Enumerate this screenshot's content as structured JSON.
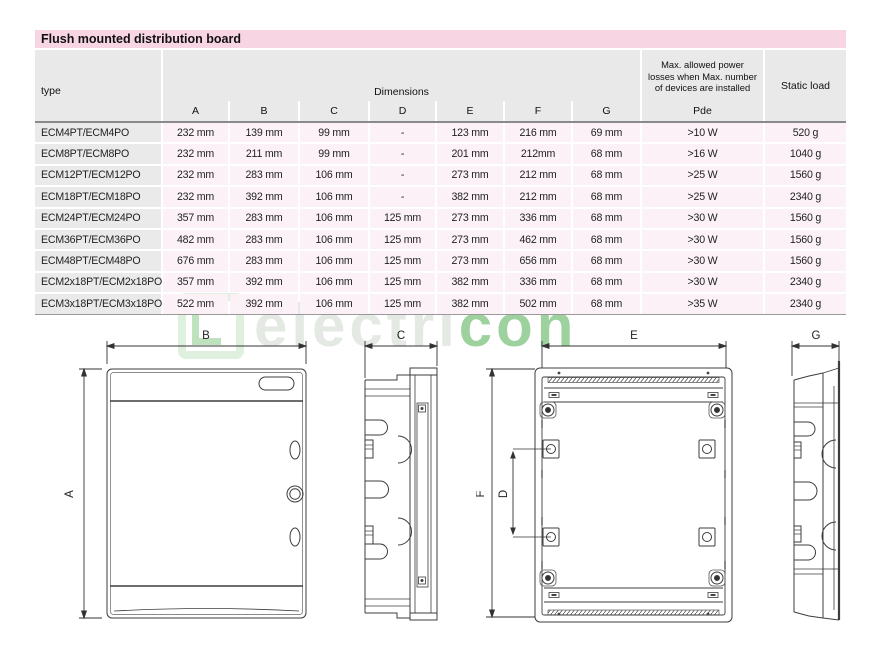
{
  "page": {
    "title": "Flush mounted distribution board"
  },
  "table": {
    "col_type": "type",
    "col_dimensions": "Dimensions",
    "dim_letters": [
      "A",
      "B",
      "C",
      "D",
      "E",
      "F",
      "G"
    ],
    "pde_lines": [
      "Max. allowed power",
      "losses when Max. number",
      "of devices are installed"
    ],
    "pde_label": "Pde",
    "col_static": "Static load",
    "rows": [
      {
        "type": "ECM4PT/ECM4PO",
        "A": "232 mm",
        "B": "139 mm",
        "C": "99 mm",
        "D": "-",
        "E": "123 mm",
        "F": "216 mm",
        "G": "69 mm",
        "pde": ">10 W",
        "static": "520 g"
      },
      {
        "type": "ECM8PT/ECM8PO",
        "A": "232 mm",
        "B": "211 mm",
        "C": "99 mm",
        "D": "-",
        "E": "201 mm",
        "F": "212mm",
        "G": "68 mm",
        "pde": ">16 W",
        "static": "1040 g"
      },
      {
        "type": "ECM12PT/ECM12PO",
        "A": "232 mm",
        "B": "283 mm",
        "C": "106 mm",
        "D": "-",
        "E": "273 mm",
        "F": "212 mm",
        "G": "68 mm",
        "pde": ">25 W",
        "static": "1560 g"
      },
      {
        "type": "ECM18PT/ECM18PO",
        "A": "232 mm",
        "B": "392 mm",
        "C": "106 mm",
        "D": "-",
        "E": "382 mm",
        "F": "212 mm",
        "G": "68 mm",
        "pde": ">25 W",
        "static": "2340 g"
      },
      {
        "type": "ECM24PT/ECM24PO",
        "A": "357 mm",
        "B": "283 mm",
        "C": "106 mm",
        "D": "125 mm",
        "E": "273 mm",
        "F": "336 mm",
        "G": "68 mm",
        "pde": ">30 W",
        "static": "1560 g"
      },
      {
        "type": "ECM36PT/ECM36PO",
        "A": "482 mm",
        "B": "283 mm",
        "C": "106 mm",
        "D": "125 mm",
        "E": "273 mm",
        "F": "462 mm",
        "G": "68 mm",
        "pde": ">30 W",
        "static": "1560 g"
      },
      {
        "type": "ECM48PT/ECM48PO",
        "A": "676 mm",
        "B": "283 mm",
        "C": "106 mm",
        "D": "125 mm",
        "E": "273 mm",
        "F": "656 mm",
        "G": "68 mm",
        "pde": ">30 W",
        "static": "1560 g"
      },
      {
        "type": "ECM2x18PT/ECM2x18PO",
        "A": "357 mm",
        "B": "392 mm",
        "C": "106 mm",
        "D": "125 mm",
        "E": "382 mm",
        "F": "336 mm",
        "G": "68 mm",
        "pde": ">30 W",
        "static": "2340 g"
      },
      {
        "type": "ECM3x18PT/ECM3x18PO",
        "A": "522 mm",
        "B": "392 mm",
        "C": "106 mm",
        "D": "125 mm",
        "E": "382 mm",
        "F": "502 mm",
        "G": "68 mm",
        "pde": ">35 W",
        "static": "2340 g"
      }
    ]
  },
  "drawings": {
    "front": {
      "top_label": "B",
      "left_label": "A"
    },
    "side_c": {
      "top_label": "C"
    },
    "back": {
      "top_label": "E",
      "outer_left_label": "F",
      "inner_left_label": "D"
    },
    "side_g": {
      "top_label": "G"
    }
  },
  "watermark": {
    "light_text": "electri",
    "green_text": "con"
  },
  "colors": {
    "title_bg": "#f8d5e2",
    "header_bg": "#e9e9e9",
    "cell_pink": "#fbf1f6",
    "type_bg": "#eaeaea",
    "wm_light": "rgba(205,215,205,0.55)",
    "wm_green": "rgba(105,185,105,0.65)"
  }
}
